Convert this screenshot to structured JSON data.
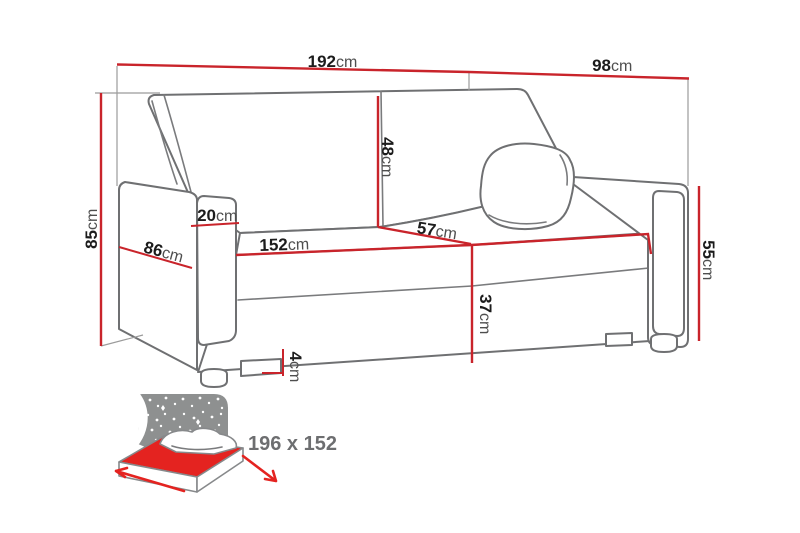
{
  "diagram": {
    "type": "sofa-bed dimension drawing",
    "dimensions": {
      "total_width": {
        "value": "192",
        "unit": "cm"
      },
      "total_depth": {
        "value": "98",
        "unit": "cm"
      },
      "total_height": {
        "value": "85",
        "unit": "cm"
      },
      "backrest_height": {
        "value": "48",
        "unit": "cm"
      },
      "armrest_width": {
        "value": "20",
        "unit": "cm"
      },
      "armrest_depth": {
        "value": "86",
        "unit": "cm"
      },
      "seat_width": {
        "value": "152",
        "unit": "cm"
      },
      "seat_depth": {
        "value": "57",
        "unit": "cm"
      },
      "seat_height": {
        "value": "37",
        "unit": "cm"
      },
      "armrest_height": {
        "value": "55",
        "unit": "cm"
      },
      "leg_height": {
        "value": "4",
        "unit": "cm"
      }
    },
    "bed_icon": {
      "sleeping_area_label": "196 x 152"
    }
  },
  "colors": {
    "accent_red": "#c9242b",
    "bed_red": "#e42320",
    "label_dark": "#1c1c1c",
    "label_gray": "#4e4e4e",
    "icon_gray": "#8e9090",
    "bed_text_gray": "#6d6e70",
    "sofa_outline_gray": "#6f7072"
  }
}
